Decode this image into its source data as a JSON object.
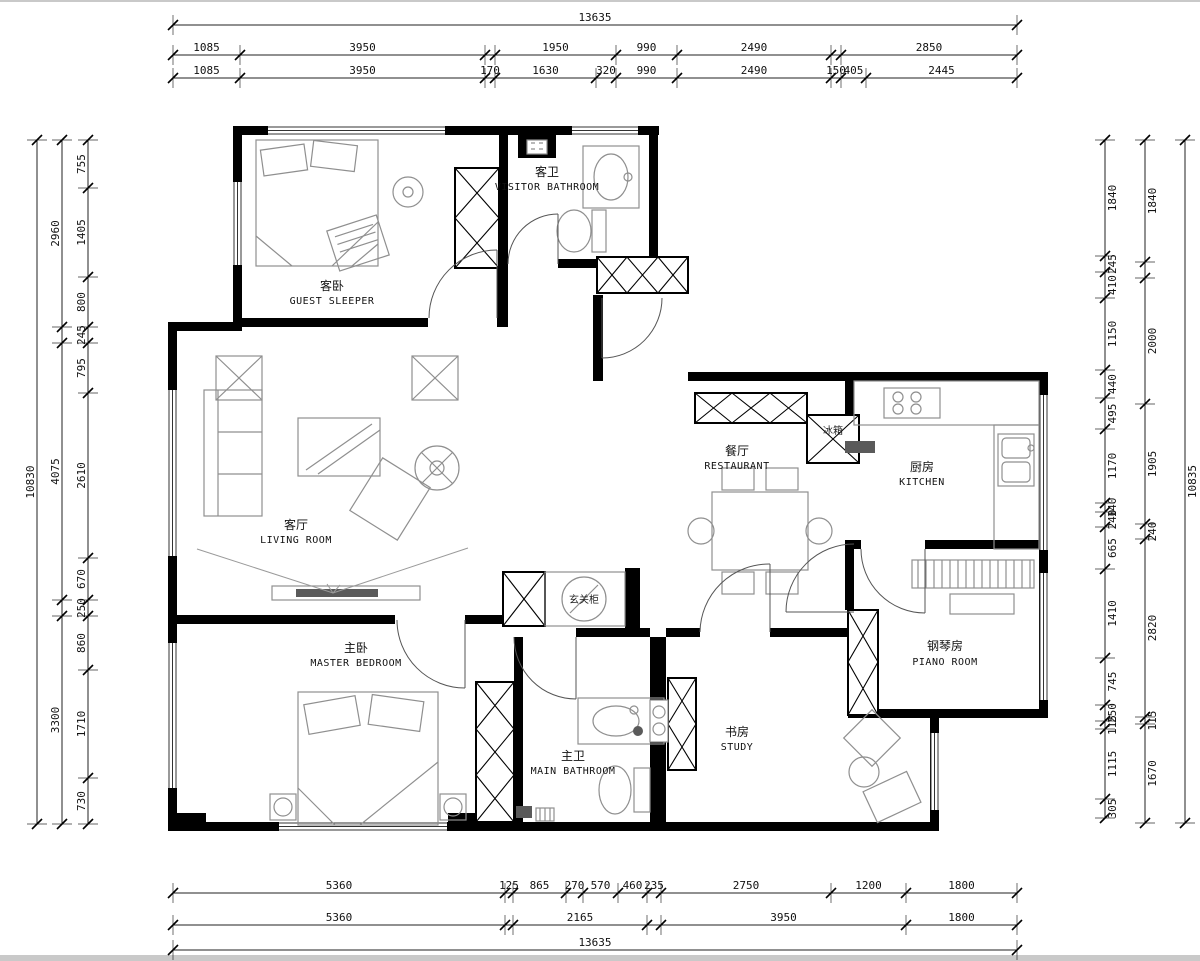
{
  "plan": {
    "type": "apartment-floor-plan",
    "wall_color": "#000000",
    "furniture_color": "#8f8f8f",
    "dimension_color": "#111111"
  },
  "rooms": [
    {
      "zh": "客卧",
      "en": "GUEST SLEEPER"
    },
    {
      "zh": "客卫",
      "en": "VISITOR BATHROOM"
    },
    {
      "zh": "客厅",
      "en": "LIVING ROOM"
    },
    {
      "zh": "餐厅",
      "en": "RESTAURANT"
    },
    {
      "zh": "厨房",
      "en": "KITCHEN"
    },
    {
      "zh": "主卧",
      "en": "MASTER BEDROOM"
    },
    {
      "zh": "主卫",
      "en": "MAIN BATHROOM"
    },
    {
      "zh": "书房",
      "en": "STUDY"
    },
    {
      "zh": "钢琴房",
      "en": "PIANO ROOM"
    }
  ],
  "annotations": {
    "fridge": "冰箱",
    "entry_cabinet": "玄关柜"
  },
  "dims": {
    "top_row1": [
      "13635"
    ],
    "top_row2": [
      "1085",
      "3950",
      "",
      "1950",
      "990",
      "2490",
      "",
      "2850"
    ],
    "top_row3": [
      "1085",
      "3950",
      "170",
      "1630",
      "320",
      "990",
      "2490",
      "150",
      "405",
      "2445"
    ],
    "bottom_row1": [
      "5360",
      "125",
      "865",
      "270",
      "570",
      "460",
      "235",
      "2750",
      "1200",
      "1800"
    ],
    "bottom_row2": [
      "5360",
      "",
      "2165",
      "",
      "3950",
      "1800"
    ],
    "bottom_row3": [
      "13635"
    ],
    "left_outer": [
      "10830"
    ],
    "left_mid": [
      "2960",
      "",
      "4075",
      "",
      "3300"
    ],
    "left_inner": [
      "755",
      "1405",
      "800",
      "245",
      "795",
      "2610",
      "670",
      "250",
      "860",
      "1710",
      "730"
    ],
    "right_inner": [
      "1840",
      "245",
      "410",
      "1150",
      "440",
      "495",
      "1170",
      "140",
      "240",
      "665",
      "1410",
      "745",
      "250",
      "115",
      "1115",
      "305"
    ],
    "right_mid": [
      "1840",
      "",
      "2000",
      "1905",
      "240",
      "2820",
      "115",
      "1670"
    ],
    "right_outer": [
      "10835"
    ]
  }
}
